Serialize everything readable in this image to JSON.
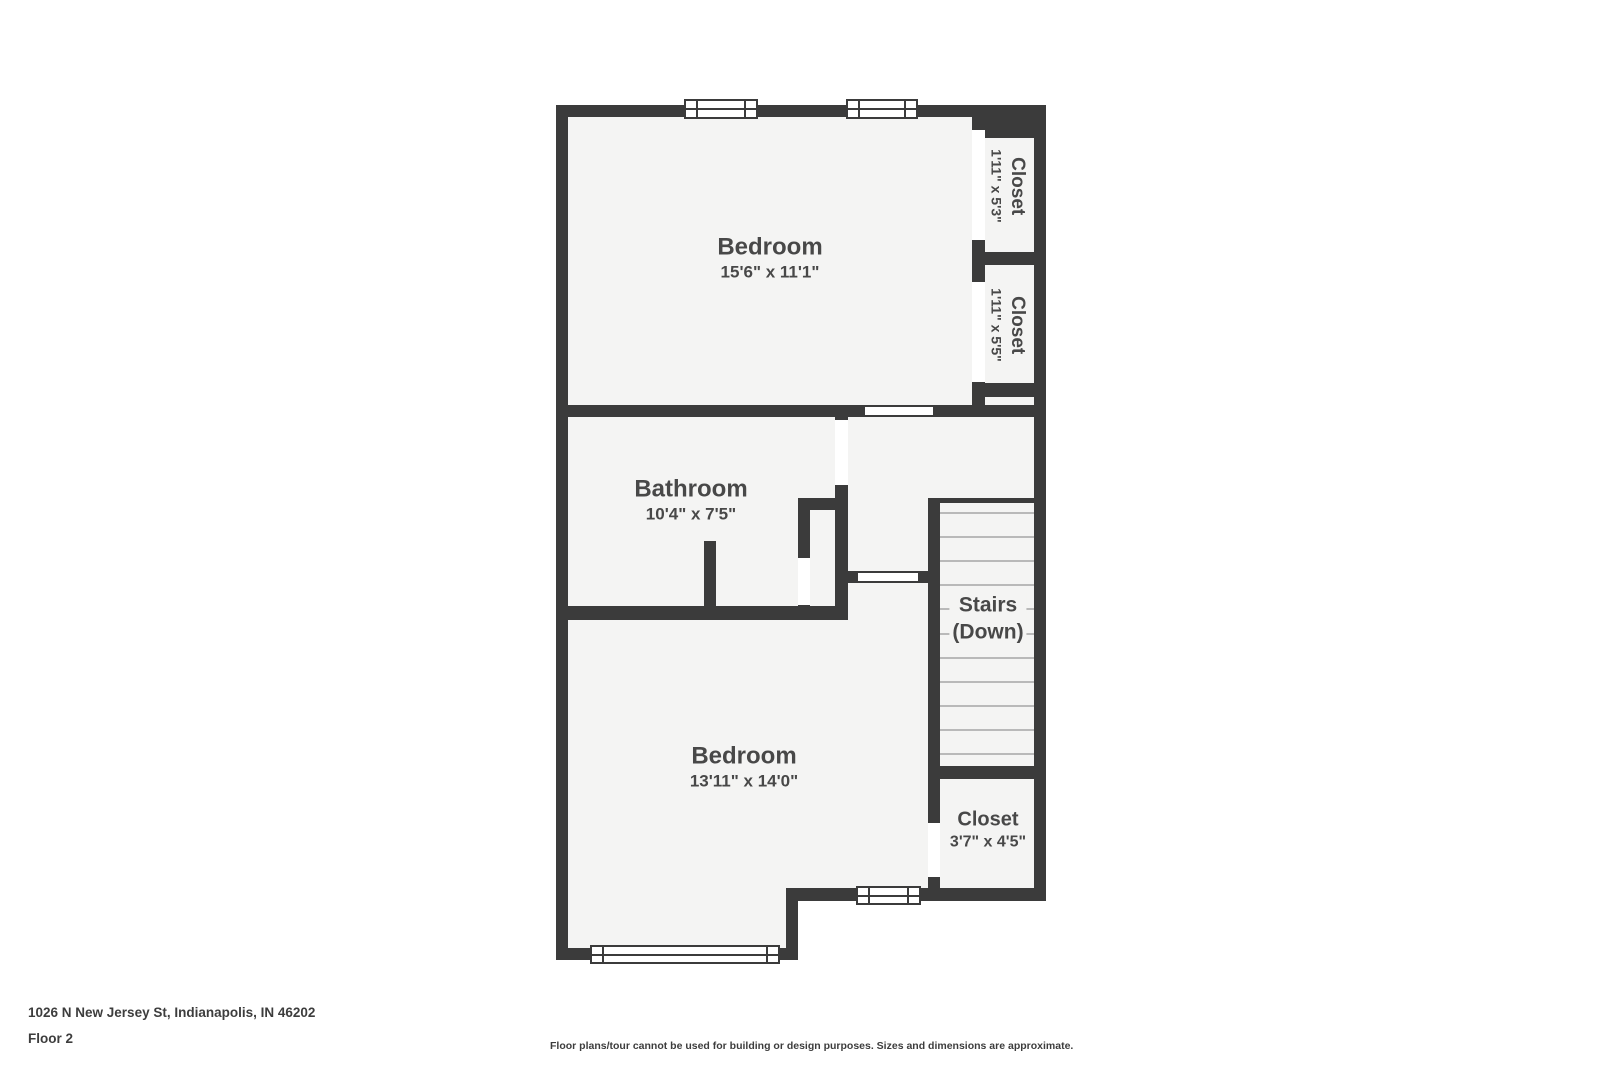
{
  "plan": {
    "rooms": {
      "bedroom_top": {
        "label": "Bedroom",
        "dims": "15'6\" x 11'1\""
      },
      "closet_top": {
        "label": "Closet",
        "dims": "1'11\" x 5'3\""
      },
      "closet_mid": {
        "label": "Closet",
        "dims": "1'11\" x 5'5\""
      },
      "bathroom": {
        "label": "Bathroom",
        "dims": "10'4\" x 7'5\""
      },
      "stairs": {
        "label": "Stairs",
        "sublabel": "(Down)"
      },
      "bedroom_bottom": {
        "label": "Bedroom",
        "dims": "13'11\" x 14'0\""
      },
      "closet_bottom": {
        "label": "Closet",
        "dims": "3'7\" x 4'5\""
      }
    }
  },
  "footer": {
    "address": "1026 N New Jersey St, Indianapolis, IN 46202",
    "floor_label": "Floor 2",
    "disclaimer": "Floor plans/tour cannot be used for building or design purposes. Sizes and dimensions are approximate."
  },
  "colors": {
    "wall": "#3b3b3b",
    "room_fill": "#f4f4f3",
    "tread_line": "#b9b9b9",
    "label_text": "#484848",
    "footer_text": "#3d3d3d",
    "background": "#ffffff"
  }
}
